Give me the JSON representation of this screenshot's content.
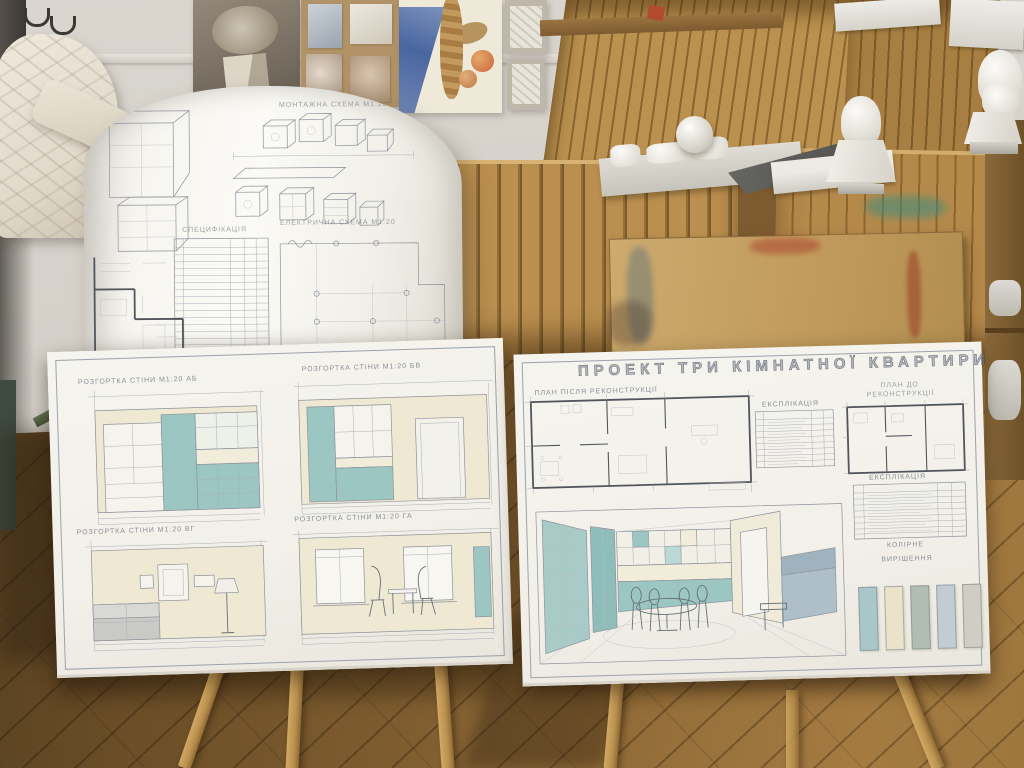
{
  "scene": {
    "title": "Art studio with three-room apartment design project on easels"
  },
  "rolled_drawing": {
    "montage_title": "МОНТАЖНА СХЕМА М1:20",
    "electric_title": "ЕЛЕКТРИЧНА СХЕМА М1:20",
    "spec_title": "СПЕЦИФІКАЦІЯ"
  },
  "left_board": {
    "panels": [
      {
        "title": "РОЗГОРТКА СТІНИ М1:20 АБ"
      },
      {
        "title": "РОЗГОРТКА СТІНИ М1:20 БВ"
      },
      {
        "title": "РОЗГОРТКА СТІНИ М1:20 ВГ"
      },
      {
        "title": "РОЗГОРТКА СТІНИ М1:20 ГА"
      }
    ]
  },
  "right_board": {
    "title": "ПРОЕКТ ТРИ КІМНАТНОЇ КВАРТИРИ",
    "plan_after_label": "ПЛАН ПІСЛЯ РЕКОНСТРУКЦІЇ",
    "plan_before_label_line1": "ПЛАН ДО",
    "plan_before_label_line2": "РЕКОНСТРУКЦІЇ",
    "explication1_label": "ЕКСПЛІКАЦІЯ",
    "explication2_label": "ЕКСПЛІКАЦІЯ",
    "color_label_line1": "КОЛІРНЕ",
    "color_label_line2": "ВИРІШЕННЯ",
    "swatches": [
      "#a9c6c8",
      "#eae3c9",
      "#b2bdb2",
      "#c2ccd2",
      "#d0cdc4"
    ]
  },
  "palette": {
    "teal_accent": "#9cc6c2",
    "cream": "#efe8d3",
    "board_paper": "#f3f1ea",
    "wood": "#b5894a",
    "floor_wood": "#7b5a30",
    "wall": "#d7d3cc"
  }
}
